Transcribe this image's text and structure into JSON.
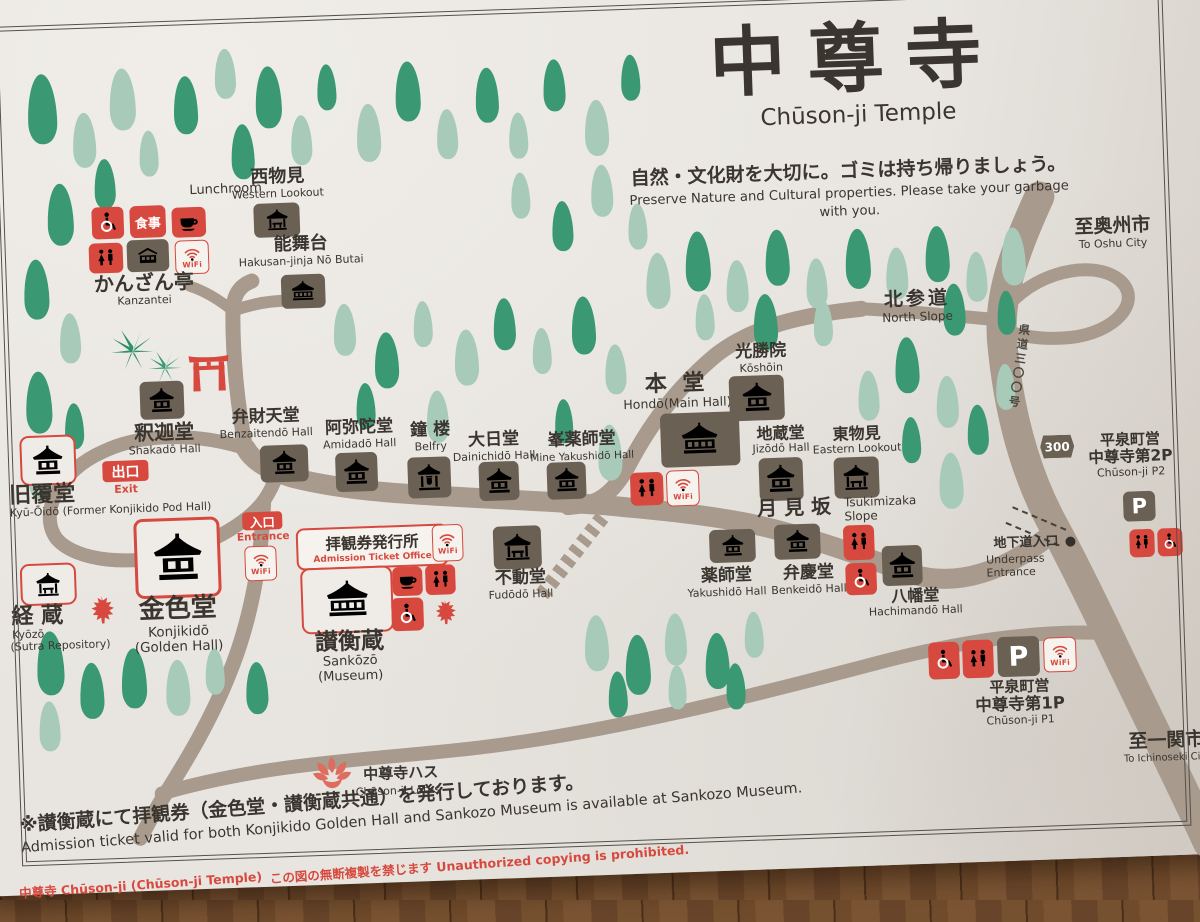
{
  "header": {
    "title_ja": "中尊寺",
    "title_en": "Chūson-ji Temple",
    "notice_ja": "自然・文化財を大切に。ゴミは持ち帰りましょう。",
    "notice_en": "Preserve Nature and Cultural properties. Please take your garbage with you."
  },
  "icon_glyphs": {
    "wifi": "WiFi",
    "meal": "食事",
    "parking": "P"
  },
  "roads": {
    "badge_300": "300",
    "pref_road_vertical": "県道三〇〇号"
  },
  "locations": {
    "lunchroom": {
      "en": "Lunchroom"
    },
    "kanzantei": {
      "ja": "かんざん亭",
      "en": "Kanzantei"
    },
    "western_lookout": {
      "ja": "西物見",
      "en": "Western Lookout"
    },
    "nobutai": {
      "ja": "能舞台",
      "en": "Hakusan-jinja Nō Butai"
    },
    "shakado": {
      "ja": "釈迦堂",
      "en": "Shakadō Hall"
    },
    "exit": {
      "ja": "出口",
      "en": "Exit"
    },
    "kyuoido": {
      "ja": "旧覆堂",
      "en": "Kyū-Ōidō (Former Konjikido Pod Hall)"
    },
    "kyozo": {
      "ja": "経 蔵",
      "en1": "Kyōzō",
      "en2": "(Sutra Repository)"
    },
    "konjikido": {
      "ja": "金色堂",
      "en1": "Konjikidō",
      "en2": "(Golden Hall)"
    },
    "entrance": {
      "ja": "入口",
      "en": "Entrance"
    },
    "ticket_office": {
      "ja": "拝観券発行所",
      "en": "Admission Ticket Office"
    },
    "sankozo": {
      "ja": "讃衡蔵",
      "en": "Sankōzō (Museum)"
    },
    "benzaitendo": {
      "ja": "弁財天堂",
      "en": "Benzaitendō Hall"
    },
    "amidado": {
      "ja": "阿弥陀堂",
      "en": "Amidadō Hall"
    },
    "belfry": {
      "ja": "鐘 楼",
      "en": "Belfry"
    },
    "dainichido": {
      "ja": "大日堂",
      "en": "Dainichidō Hall"
    },
    "mineyakushido": {
      "ja": "峯薬師堂",
      "en": "Mine Yakushidō Hall"
    },
    "fudodo": {
      "ja": "不動堂",
      "en": "Fudōdō Hall"
    },
    "hondo": {
      "ja": "本 堂",
      "en": "Hondō(Main Hall)"
    },
    "koshoin": {
      "ja": "光勝院",
      "en": "Kōshōin"
    },
    "jizodo": {
      "ja": "地蔵堂",
      "en": "Jizōdō Hall"
    },
    "eastern_lookout": {
      "ja": "東物見",
      "en": "Eastern Lookout"
    },
    "tsukimizaka": {
      "ja": "月 見 坂",
      "en1": "Tsukimizaka",
      "en2": "Slope"
    },
    "yakushido": {
      "ja": "薬師堂",
      "en": "Yakushidō Hall"
    },
    "benkeido": {
      "ja": "弁慶堂",
      "en": "Benkeidō Hall"
    },
    "hachimando": {
      "ja": "八幡堂",
      "en": "Hachimandō Hall"
    },
    "north_slope": {
      "ja": "北参道",
      "en": "North Slope"
    },
    "to_oshu": {
      "ja": "至奥州市",
      "en": "To Oshu City"
    },
    "to_ichinoseki": {
      "ja": "至一関市",
      "en": "To Ichinoseki City"
    },
    "underpass": {
      "ja": "地下道入口",
      "en": "Underpass Entrance"
    },
    "p2": {
      "ja1": "平泉町営",
      "ja2": "中尊寺第2P",
      "en": "Chūson-ji P2"
    },
    "p1": {
      "ja1": "平泉町営",
      "ja2": "中尊寺第1P",
      "en": "Chūson-ji P1"
    },
    "lotus": {
      "ja": "中尊寺ハス",
      "en": "Chūson-ji Lotus"
    }
  },
  "footer": {
    "notice_ja": "※讃衡蔵にて拝観券（金色堂・讃衡蔵共通）を発行しております。",
    "notice_en": "Admission ticket valid for both Konjikido Golden Hall and Sankozo Museum is available at Sankozo Museum.",
    "credit": "中尊寺 Chūson-ji (Chūson-ji Temple)",
    "copyright": "この図の無断複製を禁じます Unauthorized copying is prohibited."
  },
  "colors": {
    "paper": "#e8e5e0",
    "road": "#a89a8d",
    "tree_dark": "#3a9873",
    "tree_light": "#a8cbb9",
    "accent_red": "#d7493e",
    "tile_brown": "#6b6054",
    "text_dark": "#3a352e"
  }
}
